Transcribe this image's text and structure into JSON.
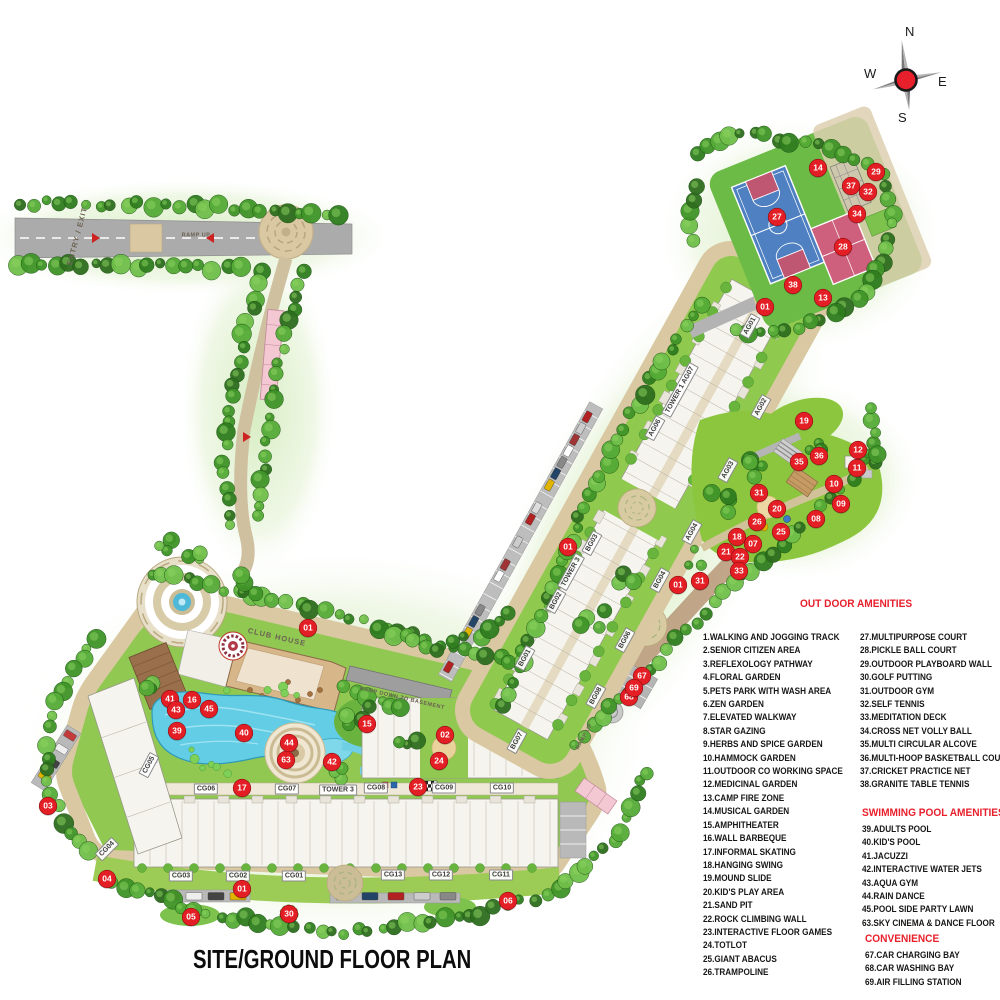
{
  "title": "SITE/GROUND FLOOR PLAN",
  "compass": {
    "north": "N",
    "south": "S",
    "east": "E",
    "west": "W"
  },
  "legend": {
    "outdoor_heading": "OUT DOOR AMENITIES",
    "outdoor_col1": [
      "1.WALKING AND JOGGING TRACK",
      "2.SENIOR CITIZEN AREA",
      "3.REFLEXOLOGY PATHWAY",
      "4.FLORAL GARDEN",
      "5.PETS PARK WITH WASH AREA",
      "6.ZEN GARDEN",
      "7.ELEVATED WALKWAY",
      "8.STAR GAZING",
      "9.HERBS AND SPICE GARDEN",
      "10.HAMMOCK GARDEN",
      "11.OUTDOOR CO WORKING SPACE",
      "12.MEDICINAL GARDEN",
      "13.CAMP FIRE ZONE",
      "14.MUSICAL GARDEN",
      "15.AMPHITHEATER",
      "16.WALL BARBEQUE",
      "17.INFORMAL SKATING",
      "18.HANGING SWING",
      "19.MOUND SLIDE",
      "20.KID'S PLAY AREA",
      "21.SAND PIT",
      "22.ROCK CLIMBING WALL",
      "23.INTERACTIVE FLOOR GAMES",
      "24.TOTLOT",
      "25.GIANT ABACUS",
      "26.TRAMPOLINE"
    ],
    "outdoor_col2": [
      "27.MULTIPURPOSE COURT",
      "28.PICKLE BALL COURT",
      "29.OUTDOOR PLAYBOARD WALL",
      "30.GOLF PUTTING",
      "31.OUTDOOR GYM",
      "32.SELF TENNIS",
      "33.MEDITATION DECK",
      "34.CROSS NET VOLLY BALL",
      "35.MULTI CIRCULAR ALCOVE",
      "36.MULTI-HOOP BASKETBALL COURT",
      "37.CRICKET PRACTICE NET",
      "38.GRANITE TABLE TENNIS"
    ],
    "pool_heading": "SWIMMING POOL AMENITIES",
    "pool_items": [
      "39.ADULTS POOL",
      "40.KID'S POOL",
      "41.JACUZZI",
      "42.INTERACTIVE WATER JETS",
      "43.AQUA GYM",
      "44.RAIN DANCE",
      "45.POOL SIDE PARTY LAWN",
      "63.SKY CINEMA & DANCE FLOOR"
    ],
    "convenience_heading": "CONVENIENCE",
    "convenience_items": [
      "67.CAR CHARGING BAY",
      "68.CAR WASHING BAY",
      "69.AIR FILLING STATION"
    ]
  },
  "plan_labels": [
    {
      "text": "CG06",
      "x": 206,
      "y": 789
    },
    {
      "text": "CG07",
      "x": 287,
      "y": 789
    },
    {
      "text": "TOWER 3",
      "x": 338,
      "y": 790
    },
    {
      "text": "CG08",
      "x": 376,
      "y": 788
    },
    {
      "text": "CG09",
      "x": 444,
      "y": 788
    },
    {
      "text": "CG10",
      "x": 502,
      "y": 788
    },
    {
      "text": "CG03",
      "x": 181,
      "y": 876
    },
    {
      "text": "CG02",
      "x": 238,
      "y": 876
    },
    {
      "text": "CG01",
      "x": 294,
      "y": 876
    },
    {
      "text": "CG13",
      "x": 393,
      "y": 875
    },
    {
      "text": "CG12",
      "x": 441,
      "y": 875
    },
    {
      "text": "CG11",
      "x": 501,
      "y": 875
    },
    {
      "text": "CG05",
      "x": 149,
      "y": 765,
      "rot": -62
    },
    {
      "text": "CG04",
      "x": 107,
      "y": 849,
      "rot": -45
    },
    {
      "text": "TOWER 3",
      "x": 571,
      "y": 572,
      "rot": -61
    },
    {
      "text": "BG01",
      "x": 525,
      "y": 658,
      "rot": -61
    },
    {
      "text": "BG02",
      "x": 556,
      "y": 601,
      "rot": -61
    },
    {
      "text": "BG03",
      "x": 592,
      "y": 543,
      "rot": -61
    },
    {
      "text": "BG04",
      "x": 660,
      "y": 580,
      "rot": -61
    },
    {
      "text": "BG06",
      "x": 625,
      "y": 640,
      "rot": -61
    },
    {
      "text": "BG07",
      "x": 517,
      "y": 741,
      "rot": -61
    },
    {
      "text": "BG08",
      "x": 596,
      "y": 696,
      "rot": -61
    },
    {
      "text": "TOWER 1 AG07",
      "x": 680,
      "y": 390,
      "rot": -61
    },
    {
      "text": "AG06",
      "x": 655,
      "y": 428,
      "rot": -61
    },
    {
      "text": "AG01",
      "x": 750,
      "y": 326,
      "rot": -61
    },
    {
      "text": "AG02",
      "x": 761,
      "y": 407,
      "rot": -61
    },
    {
      "text": "AG03",
      "x": 728,
      "y": 470,
      "rot": -61
    },
    {
      "text": "AG04",
      "x": 692,
      "y": 532,
      "rot": -61
    },
    {
      "text": "CLUB HOUSE",
      "x": 277,
      "y": 637,
      "rot": 13,
      "cls": "road"
    },
    {
      "text": "ENTRY / EXIT",
      "x": 77,
      "y": 236,
      "rot": -75,
      "cls": "road"
    },
    {
      "text": "RAMP DOWN TO BASEMENT",
      "x": 402,
      "y": 699,
      "rot": 13,
      "cls": "road tiny"
    },
    {
      "text": "RAMP UP",
      "x": 196,
      "y": 236,
      "rot": 0,
      "cls": "road tiny"
    },
    {
      "text": "RAMP UP",
      "x": 585,
      "y": 737,
      "rot": -61,
      "cls": "road tiny"
    }
  ],
  "markers": [
    {
      "n": "01",
      "x": 765,
      "y": 307
    },
    {
      "n": "01",
      "x": 568,
      "y": 547
    },
    {
      "n": "01",
      "x": 678,
      "y": 585
    },
    {
      "n": "01",
      "x": 308,
      "y": 628
    },
    {
      "n": "01",
      "x": 242,
      "y": 889
    },
    {
      "n": "02",
      "x": 445,
      "y": 735
    },
    {
      "n": "03",
      "x": 48,
      "y": 806
    },
    {
      "n": "04",
      "x": 107,
      "y": 879
    },
    {
      "n": "05",
      "x": 191,
      "y": 917
    },
    {
      "n": "06",
      "x": 508,
      "y": 901
    },
    {
      "n": "07",
      "x": 753,
      "y": 544
    },
    {
      "n": "08",
      "x": 816,
      "y": 519
    },
    {
      "n": "09",
      "x": 841,
      "y": 504
    },
    {
      "n": "10",
      "x": 834,
      "y": 484
    },
    {
      "n": "11",
      "x": 857,
      "y": 468
    },
    {
      "n": "12",
      "x": 858,
      "y": 450
    },
    {
      "n": "13",
      "x": 823,
      "y": 298
    },
    {
      "n": "14",
      "x": 818,
      "y": 168
    },
    {
      "n": "15",
      "x": 367,
      "y": 724
    },
    {
      "n": "16",
      "x": 192,
      "y": 700
    },
    {
      "n": "17",
      "x": 242,
      "y": 788
    },
    {
      "n": "18",
      "x": 737,
      "y": 537
    },
    {
      "n": "19",
      "x": 804,
      "y": 421
    },
    {
      "n": "20",
      "x": 777,
      "y": 509
    },
    {
      "n": "21",
      "x": 726,
      "y": 552
    },
    {
      "n": "22",
      "x": 740,
      "y": 557
    },
    {
      "n": "23",
      "x": 418,
      "y": 787
    },
    {
      "n": "24",
      "x": 439,
      "y": 761
    },
    {
      "n": "25",
      "x": 781,
      "y": 532
    },
    {
      "n": "26",
      "x": 757,
      "y": 522
    },
    {
      "n": "27",
      "x": 777,
      "y": 217
    },
    {
      "n": "28",
      "x": 843,
      "y": 247
    },
    {
      "n": "29",
      "x": 876,
      "y": 172
    },
    {
      "n": "30",
      "x": 289,
      "y": 914
    },
    {
      "n": "31",
      "x": 759,
      "y": 493
    },
    {
      "n": "31",
      "x": 700,
      "y": 581
    },
    {
      "n": "32",
      "x": 868,
      "y": 192
    },
    {
      "n": "33",
      "x": 739,
      "y": 571
    },
    {
      "n": "34",
      "x": 857,
      "y": 214
    },
    {
      "n": "35",
      "x": 799,
      "y": 462
    },
    {
      "n": "36",
      "x": 819,
      "y": 456
    },
    {
      "n": "37",
      "x": 851,
      "y": 186
    },
    {
      "n": "38",
      "x": 793,
      "y": 285
    },
    {
      "n": "39",
      "x": 177,
      "y": 731
    },
    {
      "n": "40",
      "x": 244,
      "y": 733
    },
    {
      "n": "41",
      "x": 170,
      "y": 699
    },
    {
      "n": "42",
      "x": 332,
      "y": 762
    },
    {
      "n": "43",
      "x": 176,
      "y": 710
    },
    {
      "n": "44",
      "x": 289,
      "y": 743
    },
    {
      "n": "45",
      "x": 209,
      "y": 709
    },
    {
      "n": "63",
      "x": 286,
      "y": 760
    },
    {
      "n": "67",
      "x": 642,
      "y": 676
    },
    {
      "n": "68",
      "x": 629,
      "y": 697
    },
    {
      "n": "69",
      "x": 634,
      "y": 688
    }
  ],
  "colors": {
    "marker_red": "#e31e25",
    "heading_red": "#e8202c",
    "road_tan": "#d9c8a1",
    "road_gray": "#ababab",
    "grass_green": "#8cc63f",
    "pool_blue": "#62cde4",
    "court_blue": "#4e80c2",
    "court_pink": "#ce5f7d"
  }
}
